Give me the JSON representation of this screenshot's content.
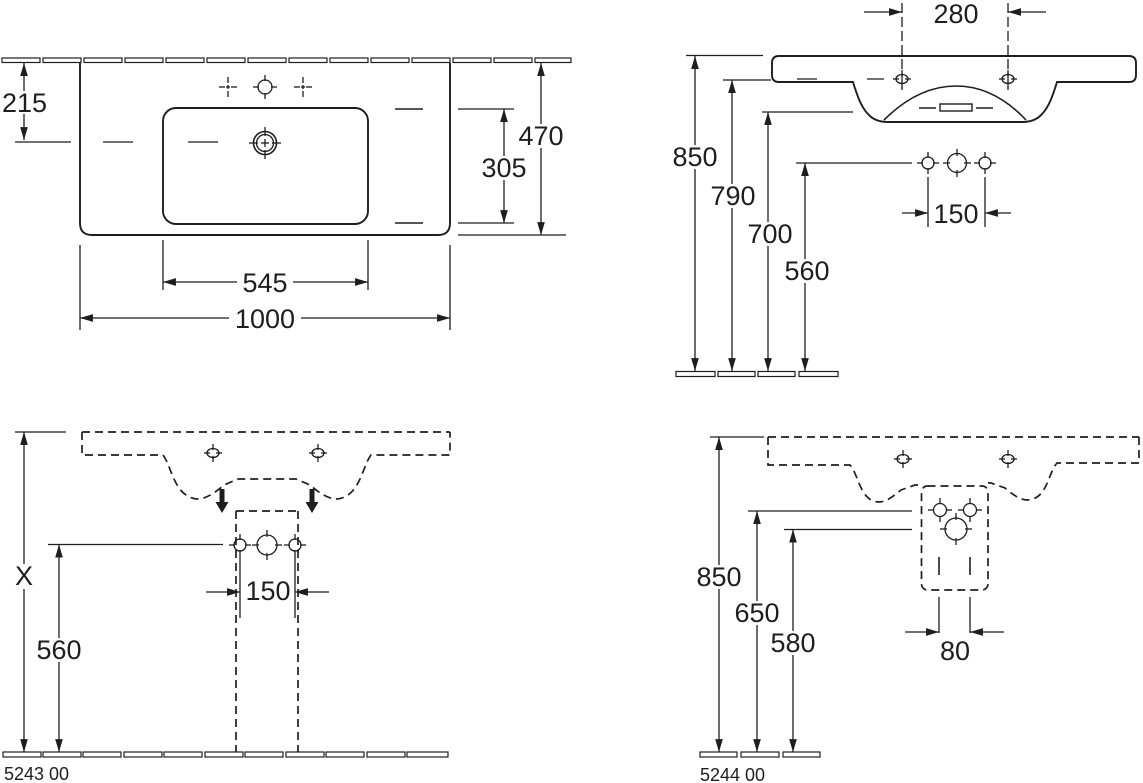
{
  "colors": {
    "background": "#ffffff",
    "line": "#1e1e1e"
  },
  "views": {
    "plan": {
      "labels": {
        "d215": "215",
        "d470": "470",
        "d305": "305",
        "d545": "545",
        "d1000": "1000"
      }
    },
    "side": {
      "labels": {
        "d280": "280",
        "d850": "850",
        "d790": "790",
        "d700": "700",
        "d560": "560",
        "d150": "150"
      }
    },
    "front_pedestal": {
      "code": "5243 00",
      "labels": {
        "dX": "X",
        "d560": "560",
        "d150": "150"
      }
    },
    "front_siphon": {
      "code": "5244 00",
      "labels": {
        "d850": "850",
        "d650": "650",
        "d580": "580",
        "d80": "80"
      }
    }
  }
}
